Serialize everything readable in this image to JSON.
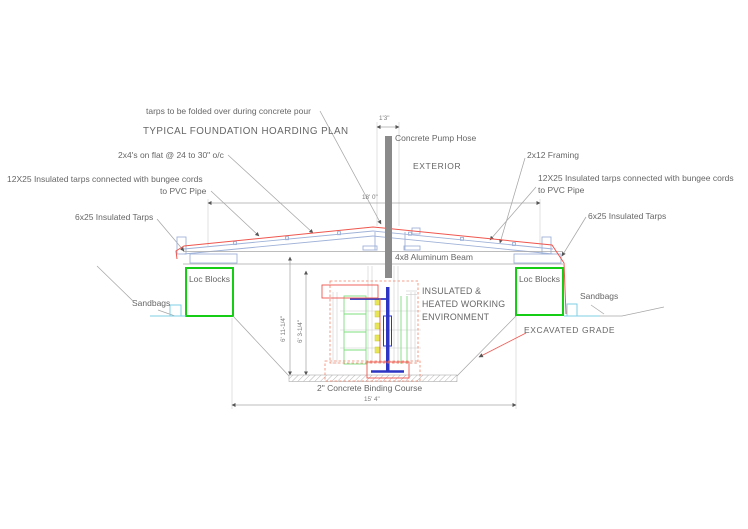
{
  "drawing": {
    "title": "TYPICAL FOUNDATION HOARDING PLAN",
    "notes": {
      "tarp_fold": "tarps to be folded over during concrete pour",
      "studs": "2x4's on flat @ 24 to 30\" o/c"
    },
    "labels": {
      "tarps12_line1": "12X25 Insulated tarps connected with bungee cords",
      "tarps12_line2": "to PVC Pipe",
      "tarps6": "6x25 Insulated Tarps",
      "sandbags": "Sandbags",
      "loc_blocks": "Loc Blocks",
      "pump_hose": "Concrete Pump Hose",
      "exterior": "EXTERIOR",
      "framing_2x12": "2x12 Framing",
      "beam": "4x8 Aluminum Beam",
      "environment_line1": "INSULATED &",
      "environment_line2": "HEATED WORKING",
      "environment_line3": "ENVIRONMENT",
      "excavated_grade": "EXCAVATED GRADE",
      "binding_course": "2\" Concrete Binding Course"
    },
    "dimensions": {
      "hose_offset": "1'3\"",
      "hoarding_span": "18' 0\"",
      "excavation_width": "15' 4\"",
      "depth_outer": "6' 11-1/4\"",
      "depth_inner": "6' 3-1/4\""
    }
  },
  "colors": {
    "ink": "#666666",
    "line_gray": "#a6a6a6",
    "framing_blue": "#9fb2d8",
    "ground_cyan": "#7fcfe6",
    "tarp_red": "#ef564e",
    "tarp_red_dash": "#f2826a",
    "loc_green": "#16cd16",
    "form_green": "#7fdc7f",
    "anchor_blue": "#2d35c2",
    "rebar_yellow": "#e8e657",
    "hose_gray": "#8a8a8a"
  }
}
